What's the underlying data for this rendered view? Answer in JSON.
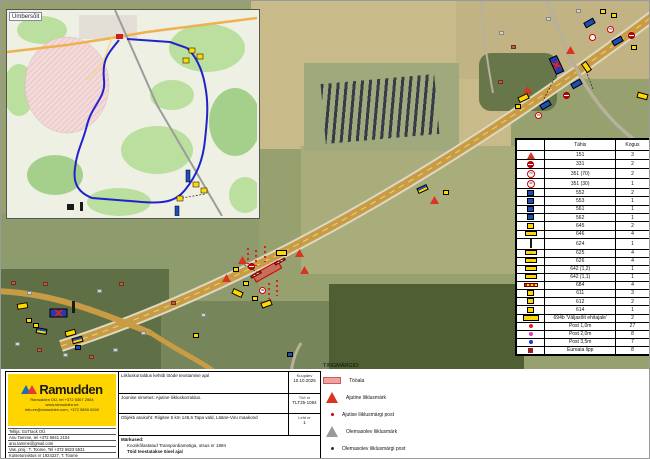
{
  "inset": {
    "label": "Ümbersõit"
  },
  "legend_table": {
    "headers": {
      "code": "Tähis",
      "qty": "Kogus"
    },
    "rows": [
      {
        "icon": "tri",
        "txt": "",
        "code": "151",
        "qty": "3"
      },
      {
        "icon": "ne",
        "txt": "",
        "code": "331",
        "qty": "2"
      },
      {
        "icon": "c",
        "txt": "70",
        "code": "351 (70)",
        "qty": "2"
      },
      {
        "icon": "c",
        "txt": "30",
        "code": "351 (30)",
        "qty": "1"
      },
      {
        "icon": "bs",
        "txt": "",
        "code": "552",
        "qty": "2"
      },
      {
        "icon": "bs",
        "txt": "",
        "code": "553",
        "qty": "1"
      },
      {
        "icon": "bs",
        "txt": "",
        "code": "561",
        "qty": "1"
      },
      {
        "icon": "bs",
        "txt": "",
        "code": "562",
        "qty": "1"
      },
      {
        "icon": "ys",
        "txt": "",
        "code": "645",
        "qty": "2"
      },
      {
        "icon": "yb",
        "txt": "",
        "code": "646",
        "qty": "4"
      },
      {
        "icon": "kp",
        "txt": "",
        "code": "624",
        "qty": "1"
      },
      {
        "icon": "yb",
        "txt": "→",
        "code": "625",
        "qty": "4"
      },
      {
        "icon": "yb",
        "txt": "←",
        "code": "626",
        "qty": "4"
      },
      {
        "icon": "yb",
        "txt": "",
        "code": "642 (1,2)",
        "qty": "1"
      },
      {
        "icon": "yb",
        "txt": "",
        "code": "642 (1,1)",
        "qty": "1"
      },
      {
        "icon": "bar",
        "txt": "",
        "code": "684",
        "qty": "4"
      },
      {
        "icon": "ys",
        "txt": "",
        "code": "611",
        "qty": "3"
      },
      {
        "icon": "ys",
        "txt": "",
        "code": "612",
        "qty": "2"
      },
      {
        "icon": "ys",
        "txt": "",
        "code": "614",
        "qty": "1"
      },
      {
        "icon": "yw",
        "txt": "",
        "code": "694b 'Väljasõit ehitajale'",
        "qty": "2"
      },
      {
        "icon": "dot-red",
        "txt": "",
        "code": "Post 1,0m",
        "qty": "27"
      },
      {
        "icon": "dot-mag",
        "txt": "",
        "code": "Post 2,0m",
        "qty": "8"
      },
      {
        "icon": "dot-blue",
        "txt": "",
        "code": "Post 3,5m",
        "qty": "7"
      },
      {
        "icon": "sq-dred",
        "txt": "",
        "code": "Euroaia lipp",
        "qty": "8"
      }
    ]
  },
  "tingmargid": {
    "title": "TINGMÄRGID:",
    "items": [
      {
        "icon": "swatch",
        "label": "Tööala"
      },
      {
        "icon": "temp-tri",
        "label": "Ajutine liiklusmärk"
      },
      {
        "icon": "temp-dot",
        "label": "Ajutise liiklusmärgi post"
      },
      {
        "icon": "ex-tri",
        "label": "Olemasolev liiklusmärk"
      },
      {
        "icon": "ex-dot",
        "label": "Olemasolev liiklusmärgi post"
      }
    ]
  },
  "info_panel": {
    "row1": "Liikluskorraldus kehtib tööde teostamise ajal",
    "drawing_title": "Joonise nimetus: Ajutine liikluskorraldus.",
    "location": "Objekti asukoht: Riigitee 5 km 145,6 Tapa vald, Lääne-Viru maakond",
    "notes_title": "Märkused:",
    "notes": [
      {
        "text": "Kooskõlastatud Transpordiametiga, otsus nr 1894",
        "bold": false
      },
      {
        "text": "Töid teostatakse öisel ajal",
        "bold": true
      }
    ],
    "date_label": "Kuupäev",
    "date": "10.10.2025",
    "work_no_label": "Töö nr",
    "work_no": "TLT25-1084",
    "sheet_label": "Leht nr",
    "sheet": "1",
    "company": {
      "name": "Ramudden",
      "addr1": "Ramudden OÜ, tel +372 5307 2554",
      "addr2": "www.ramudden.ee",
      "addr3": "info.ee@ramudden.com, +372 5859 6240"
    },
    "contact_lines": [
      "Tellija: GoTrack OÜ",
      "Anu Tamme, tel +372 5841 2104",
      "anu.tamme@gmail.com",
      "Vas. proj.: T. Toome, Tel +372 5823 5531",
      "Kutsetunnistus nr 1924227, T. Toome",
      "Tegevusluba nr ELK000623"
    ]
  },
  "map_markers": [
    {
      "t": "ys",
      "x": 599,
      "y": 8
    },
    {
      "t": "ys",
      "x": 610,
      "y": 12
    },
    {
      "t": "bb",
      "x": 583,
      "y": 19,
      "r": -30
    },
    {
      "t": "sp",
      "x": 606,
      "y": 25,
      "v": "70"
    },
    {
      "t": "sp",
      "x": 588,
      "y": 33
    },
    {
      "t": "ne",
      "x": 627,
      "y": 31
    },
    {
      "t": "bb",
      "x": 611,
      "y": 37,
      "r": -30
    },
    {
      "t": "ys",
      "x": 630,
      "y": 44
    },
    {
      "t": "wt",
      "x": 565,
      "y": 45
    },
    {
      "t": "det",
      "x": 551,
      "y": 55,
      "r": -25
    },
    {
      "t": "yb",
      "x": 580,
      "y": 63,
      "r": 55
    },
    {
      "t": "bb",
      "x": 570,
      "y": 80,
      "r": -30
    },
    {
      "t": "ne",
      "x": 562,
      "y": 91
    },
    {
      "t": "wt",
      "x": 522,
      "y": 85
    },
    {
      "t": "yb",
      "x": 517,
      "y": 94,
      "r": -25
    },
    {
      "t": "ys",
      "x": 514,
      "y": 103
    },
    {
      "t": "bb",
      "x": 539,
      "y": 101,
      "r": -30
    },
    {
      "t": "sp",
      "x": 534,
      "y": 111,
      "v": "70"
    },
    {
      "t": "yb",
      "x": 636,
      "y": 92,
      "r": 15
    },
    {
      "t": "by",
      "x": 416,
      "y": 185,
      "r": -25
    },
    {
      "t": "ys",
      "x": 442,
      "y": 189
    },
    {
      "t": "wt",
      "x": 429,
      "y": 195
    },
    {
      "t": "pc",
      "x": 246,
      "y": 247
    },
    {
      "t": "pc",
      "x": 254,
      "y": 249
    },
    {
      "t": "pc",
      "x": 263,
      "y": 245
    },
    {
      "t": "wt",
      "x": 237,
      "y": 255
    },
    {
      "t": "ne",
      "x": 247,
      "y": 262
    },
    {
      "t": "ys",
      "x": 232,
      "y": 266
    },
    {
      "t": "yb",
      "x": 275,
      "y": 249
    },
    {
      "t": "wt",
      "x": 294,
      "y": 248
    },
    {
      "t": "ta",
      "x": 251,
      "y": 266,
      "w": 30,
      "h": 9,
      "r": -29
    },
    {
      "t": "bar",
      "x": 249,
      "y": 272,
      "r": -29
    },
    {
      "t": "bar",
      "x": 273,
      "y": 259,
      "r": -29
    },
    {
      "t": "wt",
      "x": 221,
      "y": 273
    },
    {
      "t": "wt",
      "x": 299,
      "y": 265
    },
    {
      "t": "ys",
      "x": 242,
      "y": 280
    },
    {
      "t": "yb",
      "x": 231,
      "y": 289,
      "r": 25
    },
    {
      "t": "sp",
      "x": 258,
      "y": 286,
      "v": "30"
    },
    {
      "t": "pc",
      "x": 267,
      "y": 282
    },
    {
      "t": "pc",
      "x": 275,
      "y": 279
    },
    {
      "t": "ys",
      "x": 251,
      "y": 295
    },
    {
      "t": "yb",
      "x": 260,
      "y": 300,
      "r": -20
    },
    {
      "t": "bs",
      "x": 286,
      "y": 351
    },
    {
      "t": "ys",
      "x": 192,
      "y": 332
    },
    {
      "t": "yb",
      "x": 16,
      "y": 302,
      "r": -10
    },
    {
      "t": "ys",
      "x": 25,
      "y": 317
    },
    {
      "t": "ys",
      "x": 32,
      "y": 322
    },
    {
      "t": "by",
      "x": 35,
      "y": 327,
      "r": 10
    },
    {
      "t": "det",
      "x": 53,
      "y": 303,
      "r": 90
    },
    {
      "t": "kp",
      "x": 71,
      "y": 300
    },
    {
      "t": "yb",
      "x": 64,
      "y": 329,
      "r": -15
    },
    {
      "t": "by",
      "x": 71,
      "y": 336,
      "r": -15
    },
    {
      "t": "bs",
      "x": 74,
      "y": 344
    },
    {
      "t": "hr",
      "x": 10,
      "y": 280
    },
    {
      "t": "hs",
      "x": 26,
      "y": 290
    },
    {
      "t": "hr",
      "x": 42,
      "y": 281
    },
    {
      "t": "hs",
      "x": 96,
      "y": 288
    },
    {
      "t": "hr",
      "x": 118,
      "y": 281
    },
    {
      "t": "hs",
      "x": 14,
      "y": 341
    },
    {
      "t": "hr",
      "x": 36,
      "y": 347
    },
    {
      "t": "hs",
      "x": 62,
      "y": 352
    },
    {
      "t": "hr",
      "x": 88,
      "y": 354
    },
    {
      "t": "hs",
      "x": 112,
      "y": 347
    },
    {
      "t": "hs",
      "x": 140,
      "y": 330
    },
    {
      "t": "hr",
      "x": 170,
      "y": 300
    },
    {
      "t": "hs",
      "x": 200,
      "y": 312
    },
    {
      "t": "hs",
      "x": 498,
      "y": 30
    },
    {
      "t": "hr",
      "x": 510,
      "y": 44
    },
    {
      "t": "hs",
      "x": 545,
      "y": 16
    },
    {
      "t": "hr",
      "x": 497,
      "y": 79
    },
    {
      "t": "hs",
      "x": 575,
      "y": 8
    }
  ]
}
